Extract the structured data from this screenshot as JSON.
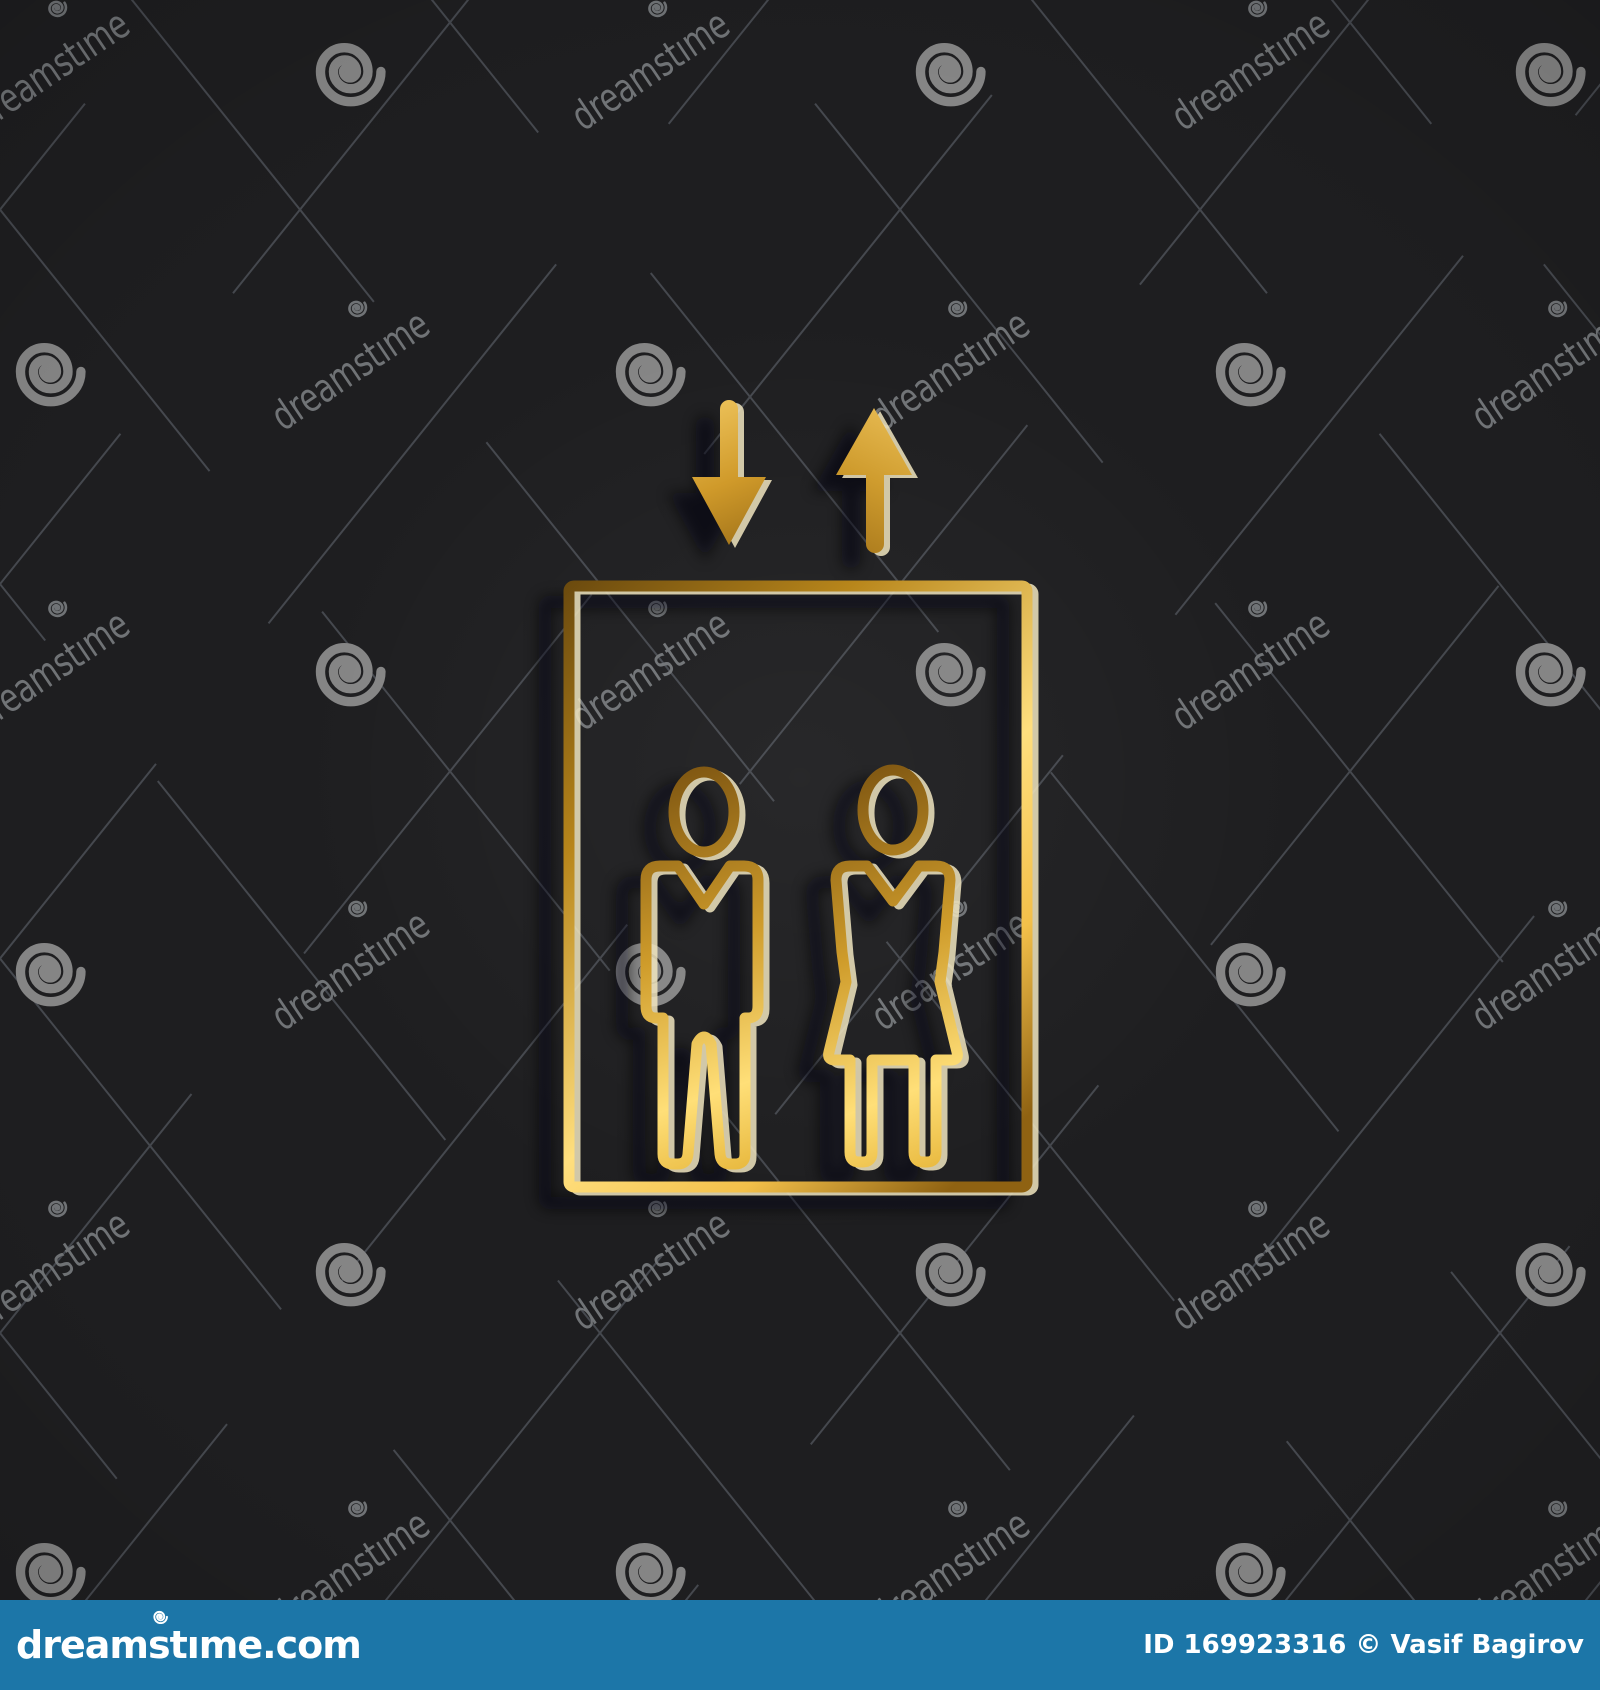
{
  "canvas": {
    "width": 1600,
    "height": 1690,
    "background_color": "#1e1e20"
  },
  "watermark": {
    "text": "dreamstime",
    "text_color": "#707376",
    "spiral_color": "#858585",
    "line_color": "#45484e",
    "text_angle_deg": -34,
    "grid": {
      "origin_x": 50,
      "origin_y": 70,
      "step_x": 300,
      "step_y": 300,
      "cols": 6,
      "rows": 6
    }
  },
  "icon": {
    "name": "gold elevator icon: cabin with man and woman, down and up arrows",
    "highlight_color": "#f1e6c0",
    "shadow_color": "#060608",
    "gradients": {
      "cabin": [
        "#6b4a0e",
        "#b8861b",
        "#ffdf7e",
        "#f3c04a",
        "#8f6212"
      ],
      "figure": [
        "#7a5210",
        "#cf9c2b",
        "#ffdf78",
        "#e8b93f"
      ],
      "arrow_down": [
        "#eec45c",
        "#d09a2a",
        "#a1731a"
      ],
      "arrow_up": [
        "#a9791c",
        "#cf9c2e",
        "#e9bd55"
      ]
    }
  },
  "footer": {
    "bar_color": "#1c76a8",
    "logo_text": "dreamstime.com",
    "credit_text": "ID 169923316 © Vasif Bagirov",
    "text_color": "#ffffff"
  }
}
